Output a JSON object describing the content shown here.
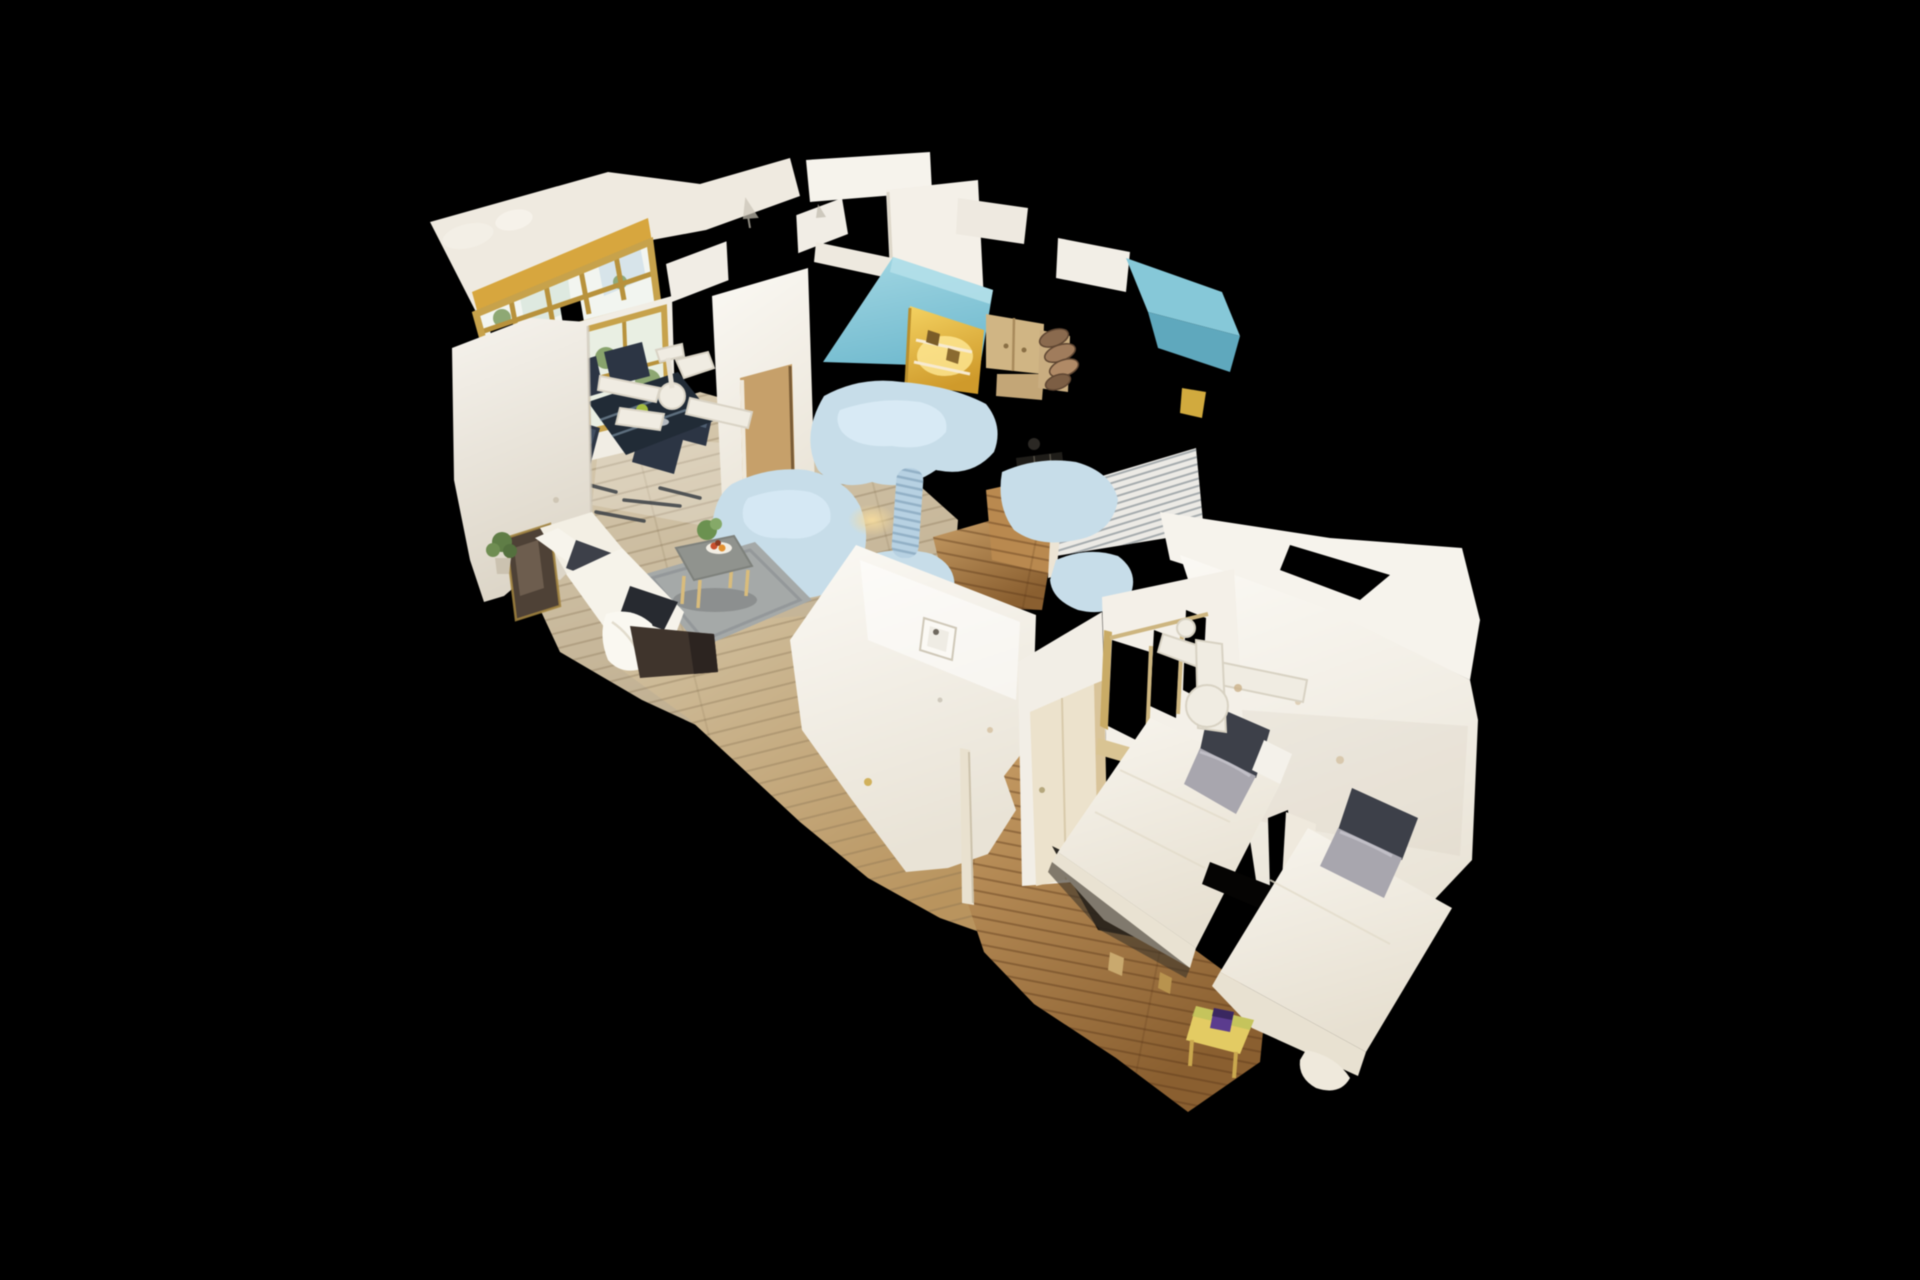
{
  "scene": {
    "title": "3D Dollhouse View",
    "type": "3d-dollhouse-scan",
    "description": "Overhead cutaway dollhouse view of a scanned one-bedroom apartment floating on a black background; living-dining room with window wall at upper left, teal-and-yellow kitchen in the center, bedroom with two white daybeds at lower right",
    "rooms": [
      {
        "name": "living-dining-room",
        "objects": [
          "exterior-window",
          "interior-window",
          "dining-table",
          "dining-chairs",
          "ceiling-fan",
          "chaise-sofa",
          "throw-pillows",
          "coffee-table",
          "fruit-bowl",
          "area-rug",
          "dresser",
          "wall-mirror",
          "house-plant",
          "wood-floor"
        ]
      },
      {
        "name": "kitchen",
        "objects": [
          "teal-walls",
          "yellow-backsplash",
          "upper-cabinets",
          "dish-rack",
          "cooktop",
          "radiator",
          "scan-artifact-fragments",
          "duct-column",
          "wood-floor"
        ]
      },
      {
        "name": "hallway",
        "objects": [
          "doorway",
          "picture-frame-wall",
          "wood-floor"
        ]
      },
      {
        "name": "bedroom",
        "objects": [
          "window",
          "door",
          "ceiling-fan",
          "daybed-1",
          "daybed-2",
          "two-tone-pillows",
          "wall-fragment",
          "side-table",
          "wood-floor"
        ]
      }
    ],
    "colors": {
      "background": "#000000",
      "wall_white": "#f4f1ea",
      "wall_bright": "#f9f6f0",
      "wall_shadow": "#ddd6c8",
      "roof_white": "#efeae0",
      "accent_yellow": "#d7a63e",
      "window_frame_gold": "#c7a24b",
      "window_mullion": "#b8923c",
      "window_pane": "#f2f5f0",
      "foliage_green": "#7d9a5e",
      "kitchen_teal": "#86c8d8",
      "kitchen_teal_light": "#b5e0ea",
      "backsplash_yellow": "#e8bc45",
      "cabinet_tan": "#d0b584",
      "dish_brown": "#8a6a4e",
      "cooktop_dark": "#1f1d19",
      "scan_artifact_blue": "#c7dde9",
      "floor_light_wood": "#cdbc9e",
      "floor_warm_wood": "#b08048",
      "rug_gray": "#a5a9a8",
      "sofa_cream": "#f3efe4",
      "sofa_base_brown": "#3f342c",
      "pillow_dark": "#3d4049",
      "pillow_silver": "#a8a6ae",
      "dining_table_navy": "#212b36",
      "chair_navy": "#2c3544",
      "bed_white": "#f5f2ea",
      "door_cream": "#ece2cc",
      "door_frame_tan": "#d9c49a",
      "side_table_yellow": "#e3cb63",
      "side_table_item_purple": "#5b3c8e",
      "fan_white": "#f0ece2",
      "dresser_dark": "#2e2925",
      "mirror_dark": "#4e4136"
    }
  }
}
